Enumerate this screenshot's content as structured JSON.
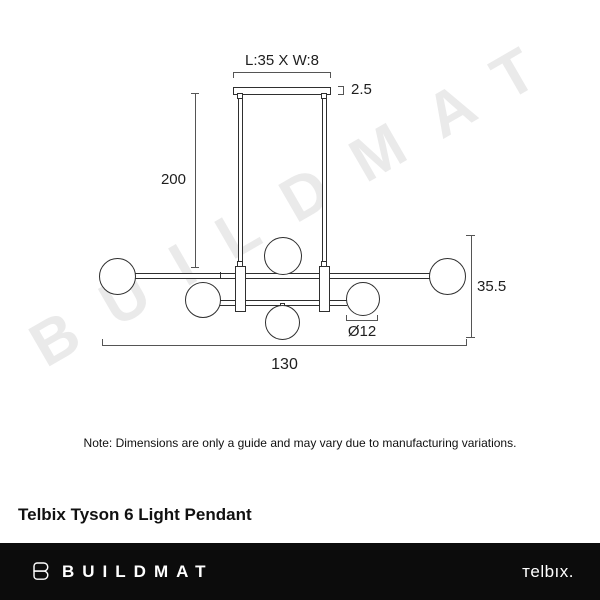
{
  "watermark": "BUILDMAT",
  "diagram": {
    "labels": {
      "canopy_dimensions": "L:35 X W:8",
      "canopy_height": "2.5",
      "suspension_length": "200",
      "fixture_height": "35.5",
      "shade_diameter": "Ø12",
      "fixture_length": "130"
    }
  },
  "note": "Note: Dimensions are only a guide and may vary due to manufacturing variations.",
  "product_title": "Telbix Tyson 6 Light Pendant",
  "footer": {
    "brand_name": "BUILDMAT",
    "partner_logo": "тelbıx."
  },
  "colors": {
    "line": "#2f2f2f",
    "dimension_line": "#555555",
    "watermark": "#eaeaea",
    "footer_background": "#0c0c0c",
    "footer_text": "#ffffff",
    "background": "#ffffff"
  }
}
